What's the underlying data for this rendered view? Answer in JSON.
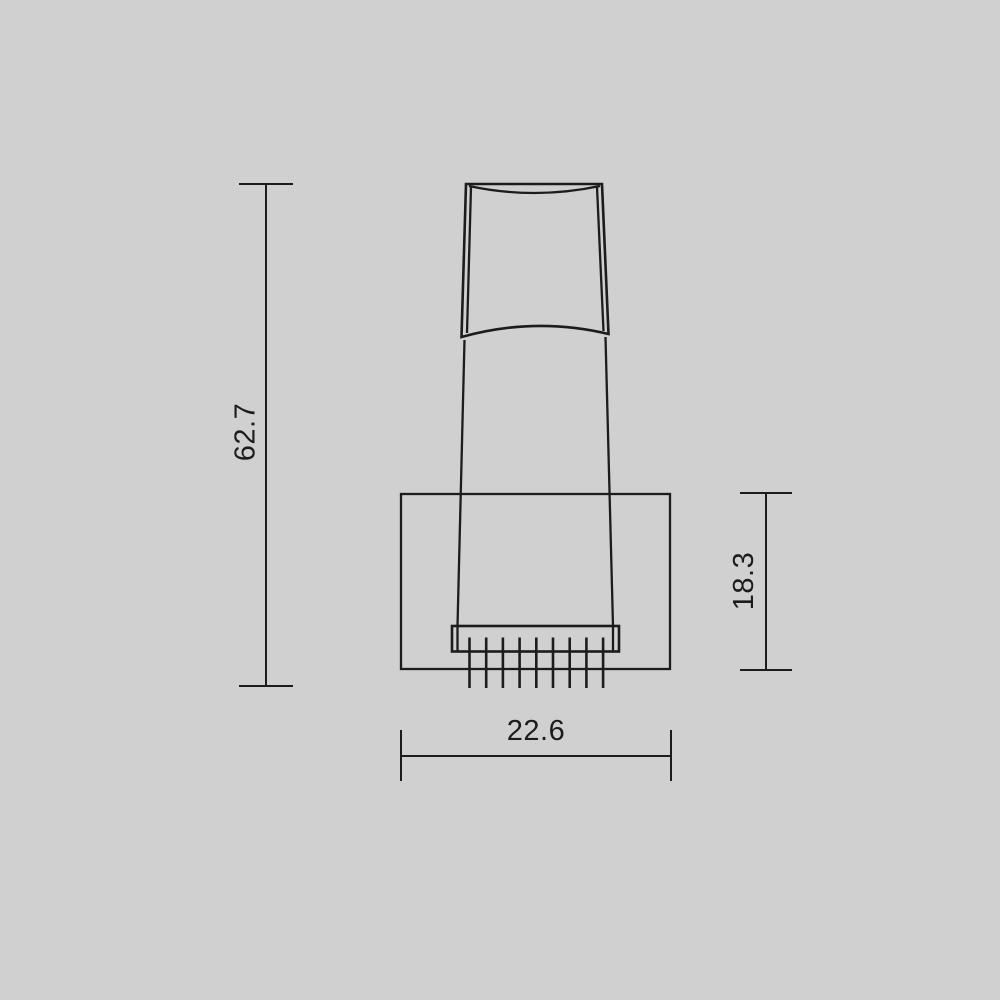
{
  "canvas": {
    "background_color": "#d0d0d0",
    "line_color": "#1c1c1c",
    "drawing_type": "technical-dimension-drawing"
  },
  "dimensions": {
    "overall_height": {
      "label": "62.7"
    },
    "housing_height": {
      "label": "18.3"
    },
    "housing_width": {
      "label": "22.6"
    }
  }
}
